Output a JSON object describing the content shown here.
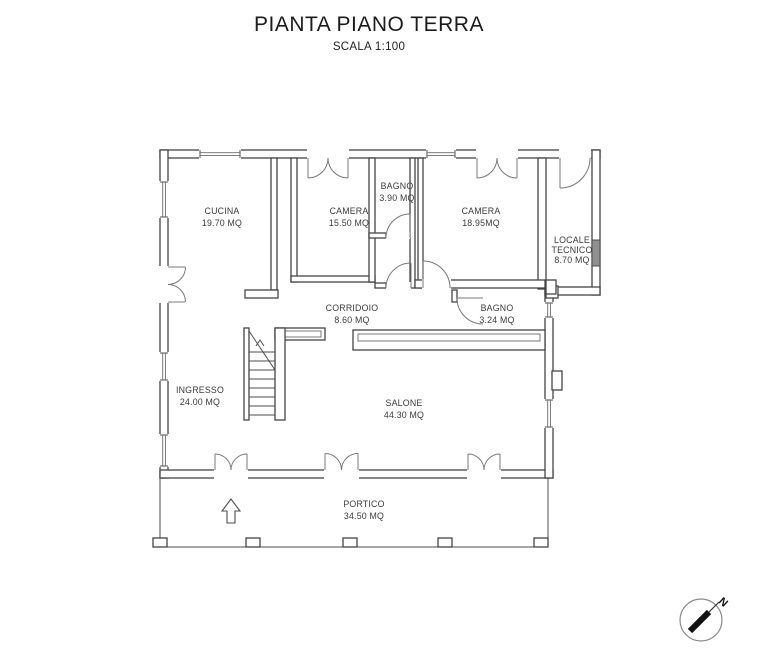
{
  "header": {
    "title": "PIANTA PIANO TERRA",
    "subtitle": "SCALA 1:100"
  },
  "compass": {
    "north_label": "N"
  },
  "rooms": {
    "cucina": {
      "name": "CUCINA",
      "area": "19.70 MQ"
    },
    "camera1": {
      "name": "CAMERA",
      "area": "15.50 MQ"
    },
    "bagno1": {
      "name": "BAGNO",
      "area": "3.90 MQ"
    },
    "camera2": {
      "name": "CAMERA",
      "area": "18.95MQ"
    },
    "locale_tecnico": {
      "name_line1": "LOCALE",
      "name_line2": "TECNICO",
      "area": "8.70 MQ"
    },
    "corridoio": {
      "name": "CORRIDOIO",
      "area": "8.60 MQ"
    },
    "bagno2": {
      "name": "BAGNO",
      "area": "3.24 MQ"
    },
    "ingresso": {
      "name": "INGRESSO",
      "area": "24.00 MQ"
    },
    "salone": {
      "name": "SALONE",
      "area": "44.30 MQ"
    },
    "portico": {
      "name": "PORTICO",
      "area": "34.50 MQ"
    }
  }
}
